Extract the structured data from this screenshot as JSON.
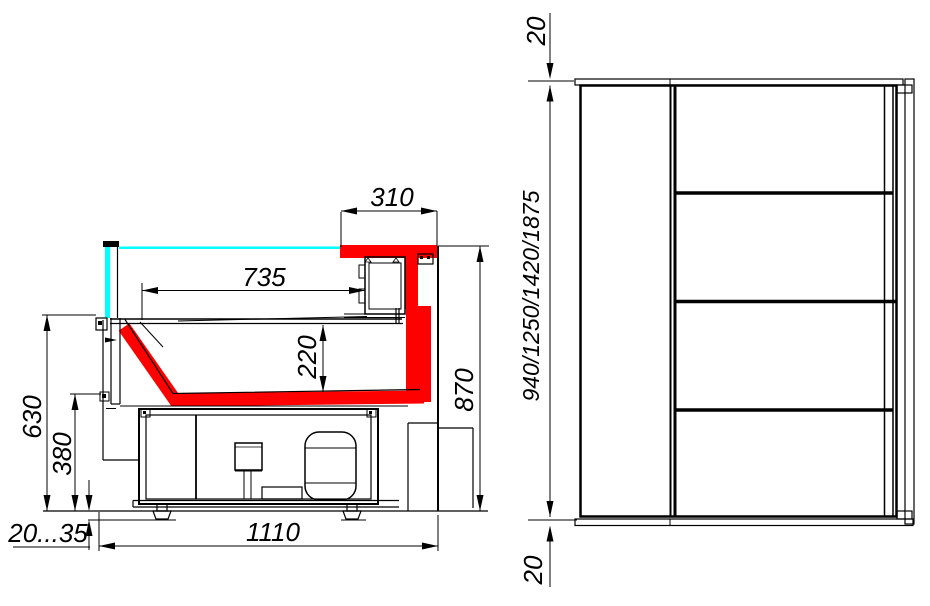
{
  "drawing": {
    "kind": "refrigerated-display-case-technical-drawing",
    "views": {
      "side_section": {
        "name": "side cross-section view",
        "dimensions": {
          "canopy_depth": "310",
          "display_surface_length": "735",
          "well_depth": "220",
          "overall_height": "870",
          "counter_front_height": "630",
          "well_bottom_height": "380",
          "feet_adjust_range": "20...35",
          "base_depth": "1110"
        }
      },
      "front_view": {
        "name": "front/plan view",
        "dimensions": {
          "top_end_panel_thickness": "20",
          "length_options": "940/1250/1420/1875",
          "bottom_end_panel_thickness": "20"
        }
      }
    },
    "colors": {
      "line": "#000000",
      "glass": "#00ffff",
      "highlight_profile": "#ff0000",
      "background": "#ffffff"
    }
  }
}
